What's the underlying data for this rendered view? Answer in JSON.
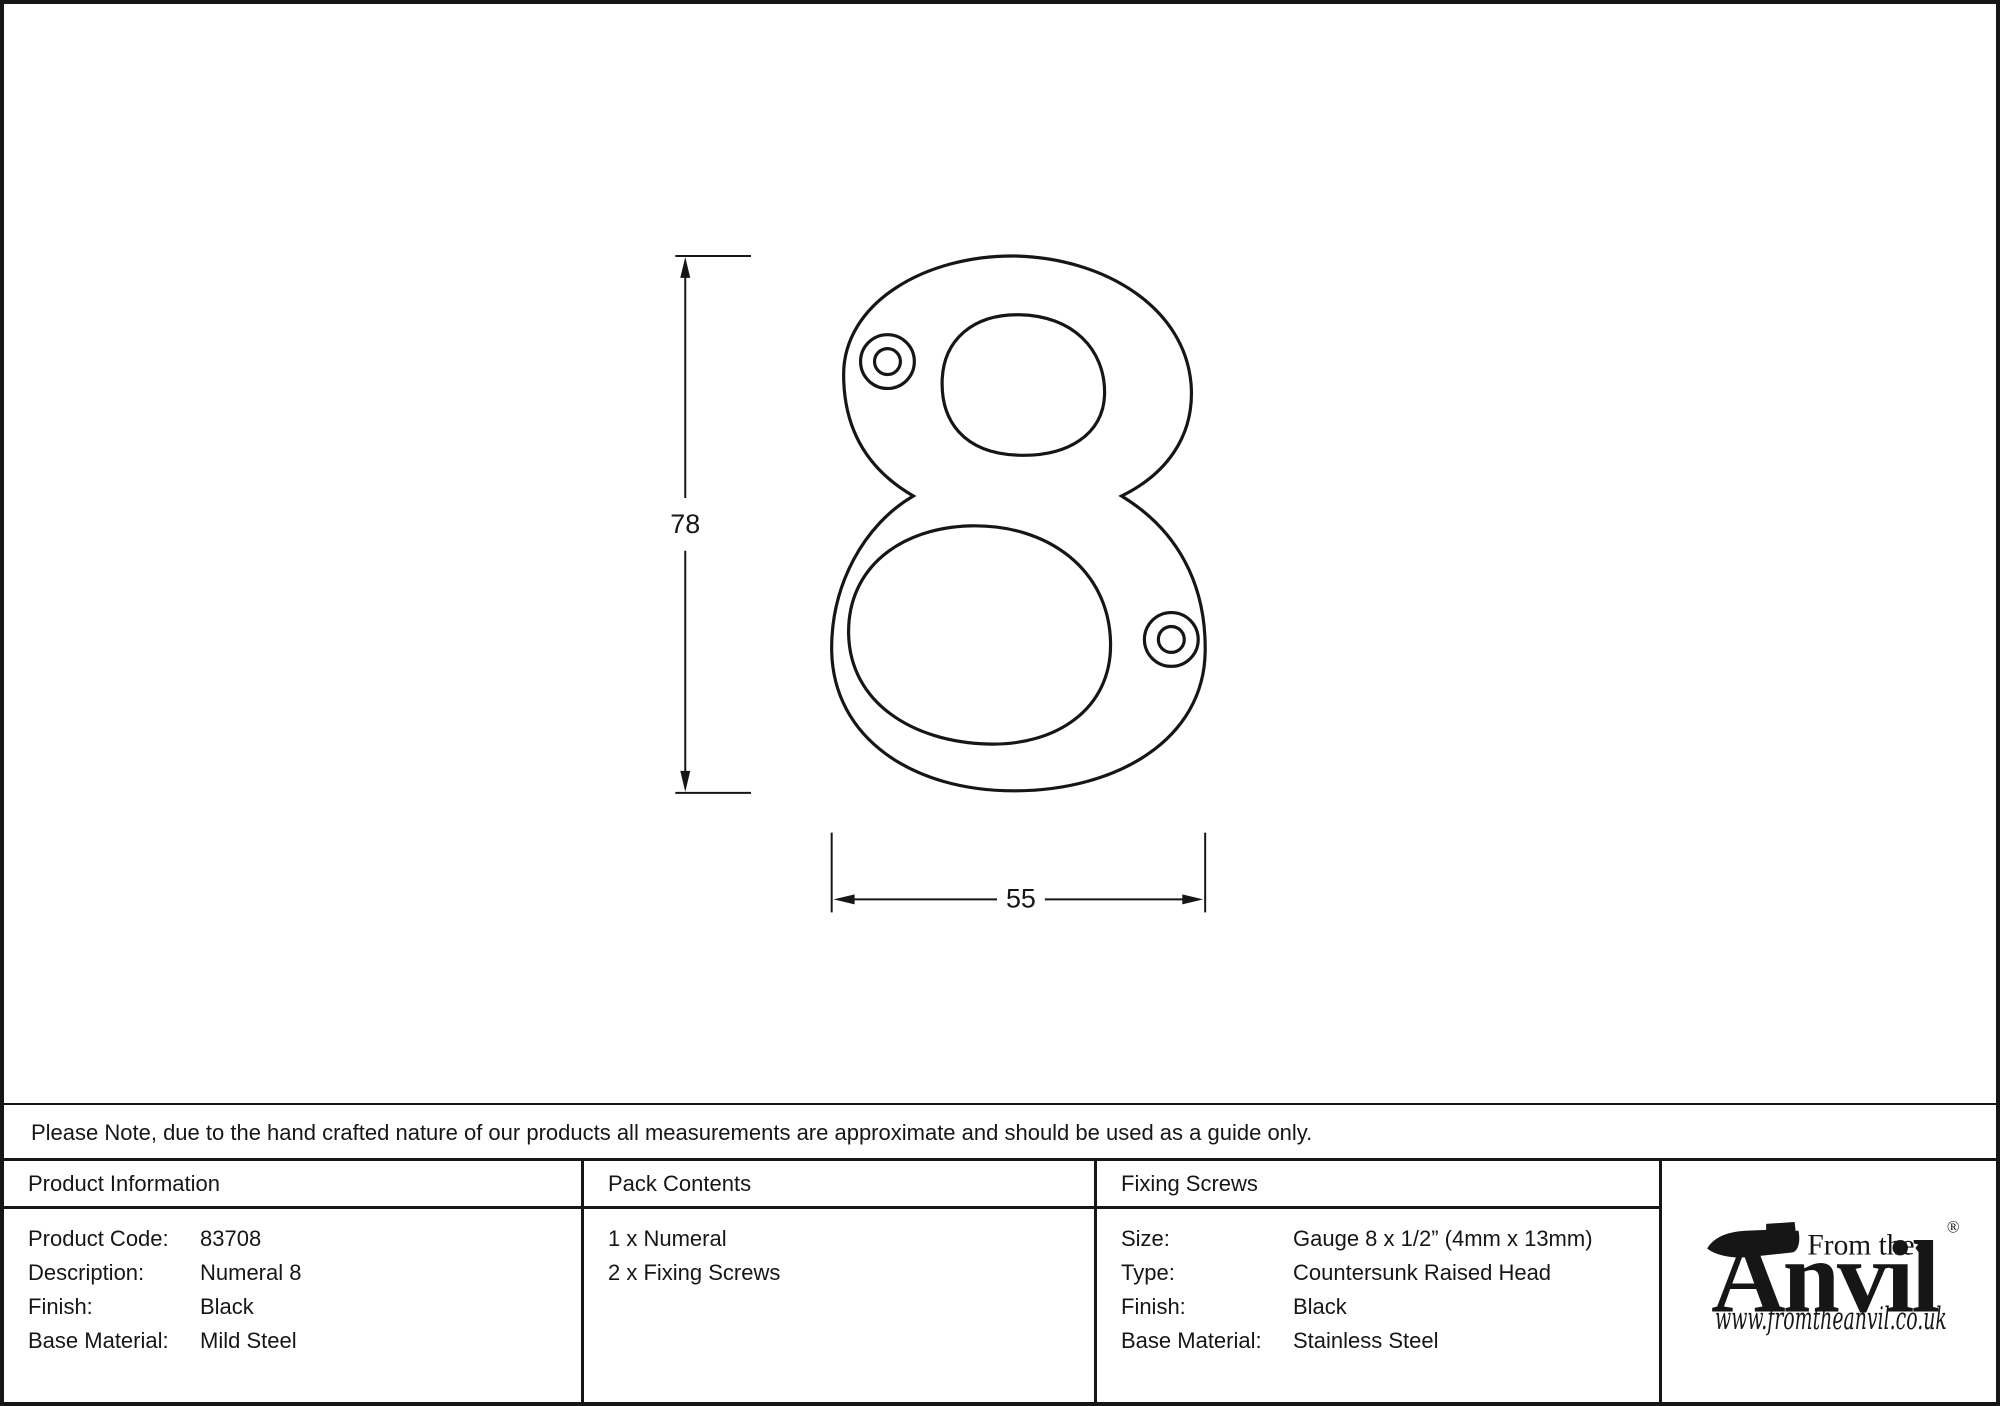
{
  "drawing": {
    "height_mm": "78",
    "width_mm": "55"
  },
  "note": {
    "text": "Please Note, due to the hand crafted nature of our products all measurements are approximate and should be used as a guide only."
  },
  "table": {
    "product_information": {
      "header": "Product Information",
      "rows": [
        {
          "label": "Product Code:",
          "value": "83708"
        },
        {
          "label": "Description:",
          "value": "Numeral 8"
        },
        {
          "label": "Finish:",
          "value": "Black"
        },
        {
          "label": "Base Material:",
          "value": "Mild Steel"
        }
      ]
    },
    "pack_contents": {
      "header": "Pack Contents",
      "items": [
        "1 x Numeral",
        "2 x Fixing Screws"
      ]
    },
    "fixing_screws": {
      "header": "Fixing Screws",
      "rows": [
        {
          "label": "Size:",
          "value": "Gauge 8 x 1/2” (4mm x 13mm)"
        },
        {
          "label": "Type:",
          "value": "Countersunk Raised Head"
        },
        {
          "label": "Finish:",
          "value": "Black"
        },
        {
          "label": "Base Material:",
          "value": "Stainless Steel"
        }
      ]
    }
  },
  "logo": {
    "prefix": "From the",
    "diamond": "♦",
    "wordmark": "Anvil",
    "registered": "®",
    "website": "www.fromtheanvil.co.uk"
  },
  "colors": {
    "ink": "#161616",
    "background": "#ffffff"
  }
}
